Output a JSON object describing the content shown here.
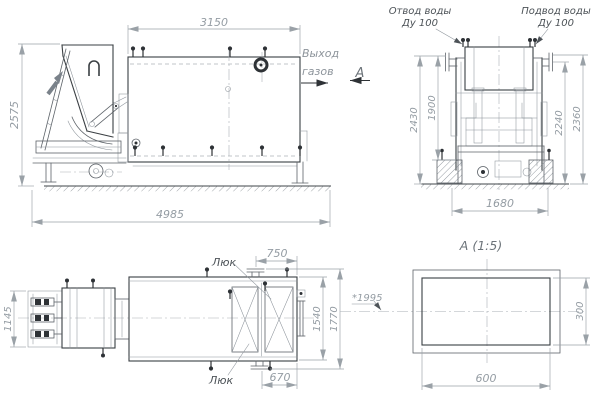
{
  "drawing": {
    "colors": {
      "background": "#ffffff",
      "outline": "#3a3f43",
      "thin_line": "#8d949b",
      "dimension": "#9aa1a7",
      "dimension_text": "#949ca3",
      "label_text": "#4d5358"
    },
    "side_view": {
      "dim_tank_length": "3150",
      "dim_overall_height": "2575",
      "dim_overall_length": "4985",
      "gas_outlet_line1": "Выход",
      "gas_outlet_line2": "газов",
      "view_arrow_label": "А"
    },
    "end_view": {
      "label_outlet_line1": "Отвод воды",
      "label_outlet_line2": "Ду 100",
      "label_inlet_line1": "Подвод воды",
      "label_inlet_line2": "Ду 100",
      "dim_overall_height": "2430",
      "dim_frame_height": "1900",
      "dim_pipe_axis_height": "2240",
      "dim_pipe_top_height": "2360",
      "dim_foundation_span": "1680"
    },
    "plan_view": {
      "dim_feeder_width": "1145",
      "dim_top_nozzle_offset": "750",
      "dim_bottom_nozzle_offset": "670",
      "dim_tank_width": "1540",
      "dim_overall_width": "1770",
      "label_hatch_top": "Люк",
      "label_hatch_bottom": "Люк",
      "ref_dimension": "*1995"
    },
    "section_view": {
      "title": "А (1:5)",
      "dim_width": "600",
      "dim_height": "300"
    }
  }
}
